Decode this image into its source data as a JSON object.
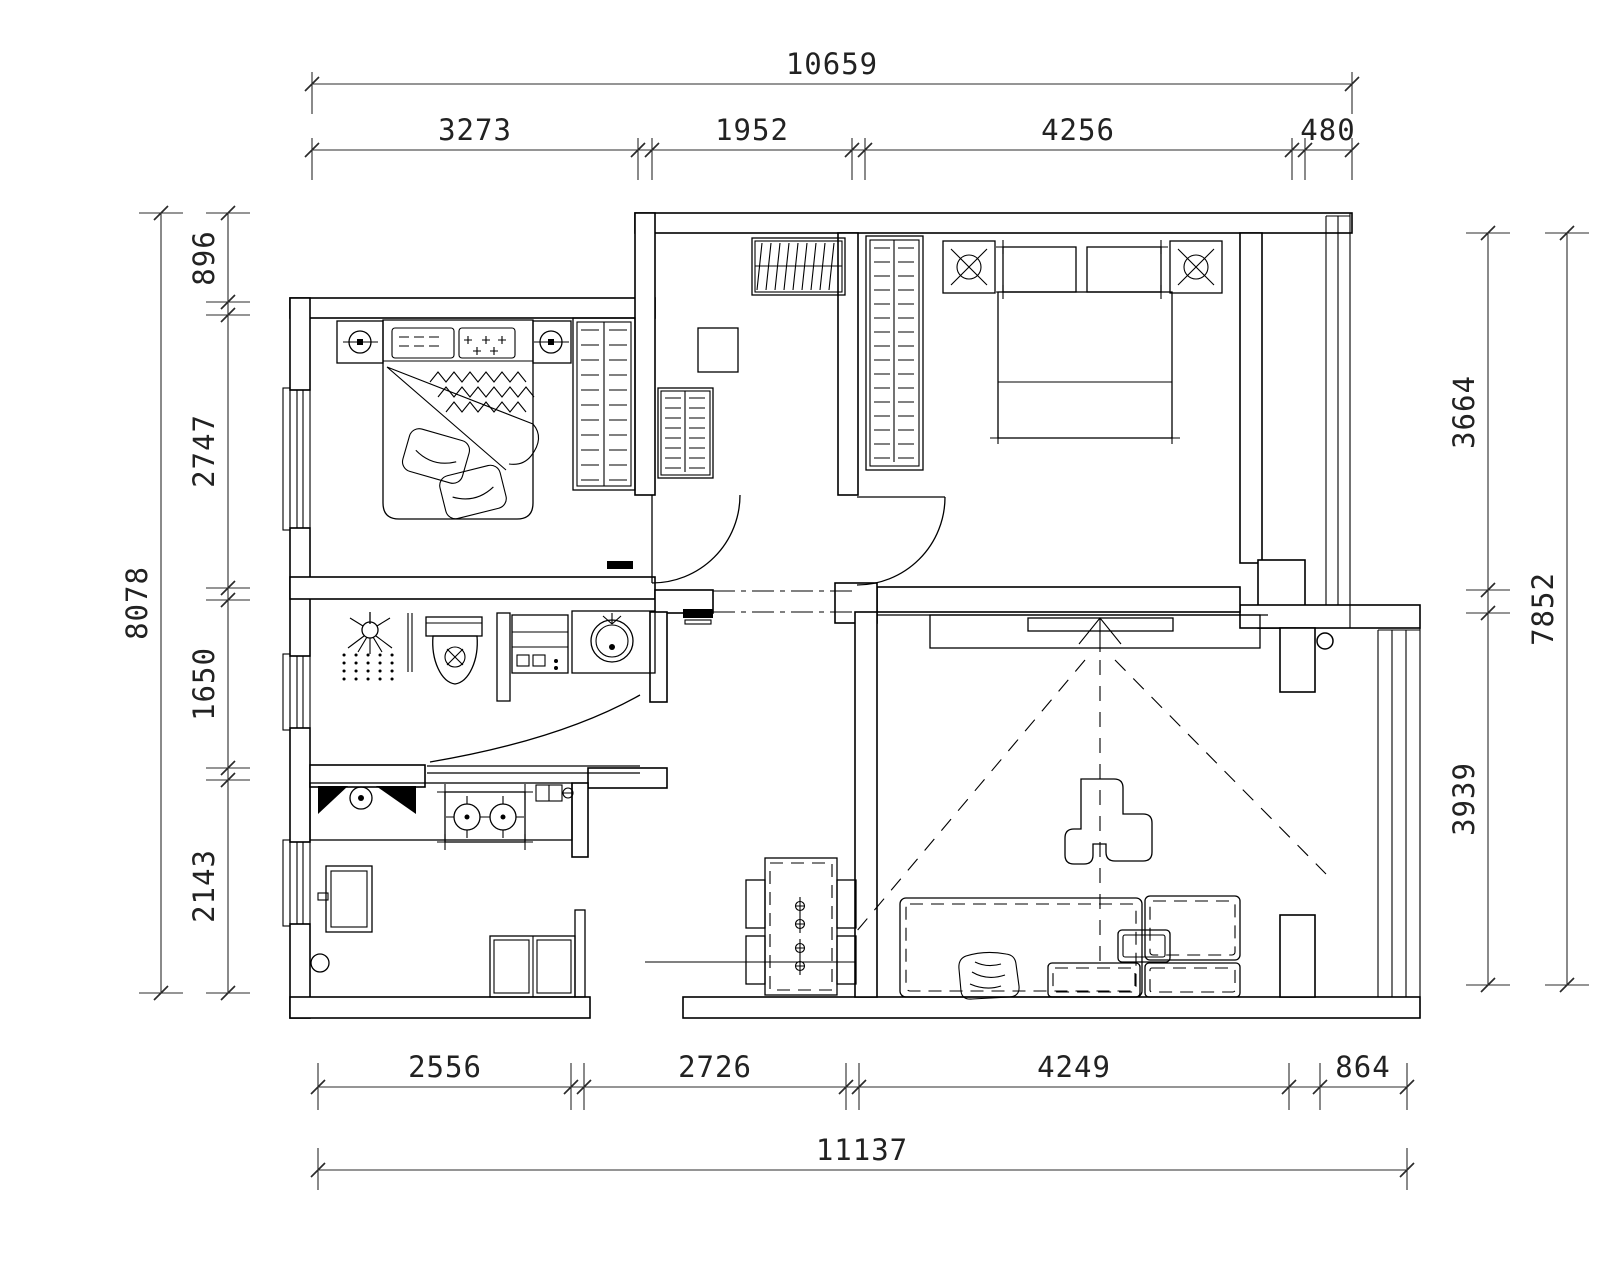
{
  "drawing": {
    "type": "architectural-floor-plan",
    "colors": {
      "background": "#ffffff",
      "line": "#000000",
      "dim_text": "#222222"
    },
    "dimensions": {
      "top": {
        "overall": "10659",
        "segments": [
          "3273",
          "1952",
          "4256",
          "480"
        ]
      },
      "bottom": {
        "overall": "11137",
        "segments": [
          "2556",
          "2726",
          "4249",
          "864"
        ]
      },
      "left": {
        "overall": "8078",
        "segments": [
          "896",
          "2747",
          "1650",
          "2143"
        ]
      },
      "right": {
        "overall": "7852",
        "segments": [
          "3664",
          "3939"
        ]
      }
    },
    "symbols": {
      "bedroom_1": [
        "double-bed",
        "pillows",
        "bedside-lamps",
        "wardrobe-with-hangers"
      ],
      "hallway": [
        "shoe-rack",
        "storage-cabinet",
        "small-rack",
        "door-swings",
        "thresholds"
      ],
      "bedroom_2": [
        "double-bed",
        "nightstand-lamps",
        "wardrobe-with-hangers"
      ],
      "bathroom": [
        "shower",
        "glass-partition",
        "toilet",
        "storage-shelf",
        "round-washbasin",
        "door-swing"
      ],
      "kitchen": [
        "double-sink",
        "two-burner-gas-stove",
        "refrigerator",
        "base-cabinet",
        "floor-drain"
      ],
      "living_room": [
        "tv-cabinet",
        "tv-projection-lines",
        "coffee-table",
        "sectional-sofa",
        "blanket",
        "dining-table",
        "dining-chairs",
        "door-stopper"
      ],
      "windows": [
        "left-wall-windows",
        "right-bay-window",
        "living-room-bay-window"
      ]
    }
  }
}
